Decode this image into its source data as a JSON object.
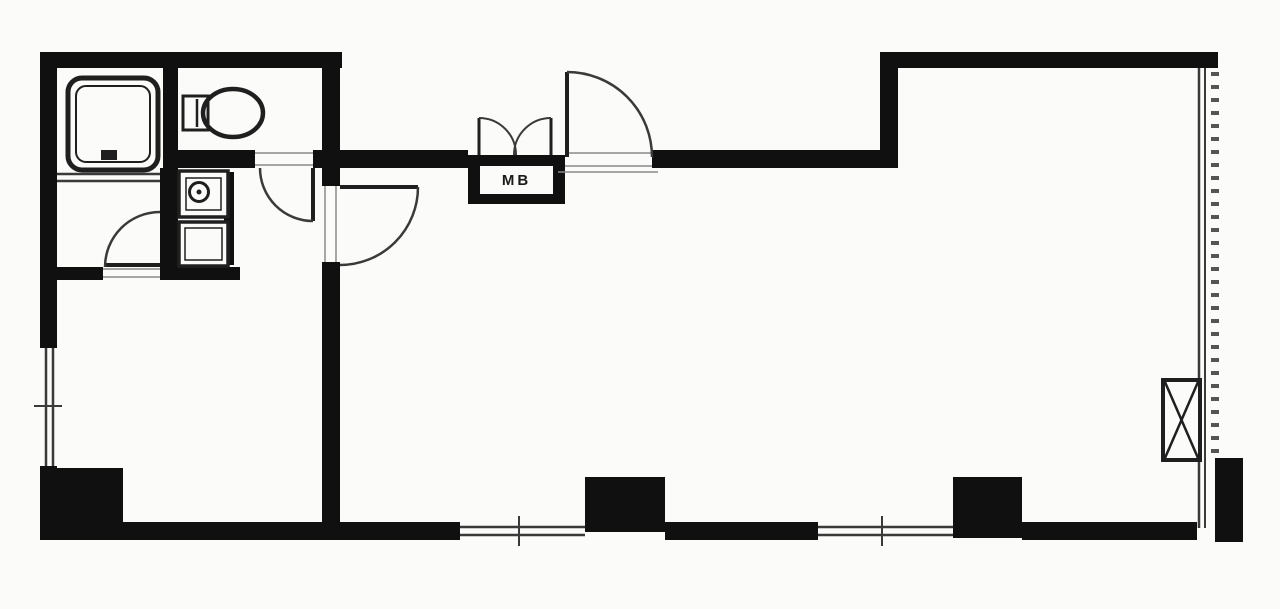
{
  "canvas": {
    "width": 1280,
    "height": 609
  },
  "colors": {
    "wall": "#101010",
    "dark": "#1f1f1f",
    "line": "#3a3a3a",
    "faint": "#8a8a8a",
    "hatch": "#555555",
    "paper": "#fbfbf9"
  },
  "labels": {
    "meter_box": "MB"
  },
  "meter_box_label_box": {
    "left": 480,
    "top": 166,
    "width": 73,
    "height": 28
  },
  "plan": {
    "shapes": [
      {
        "t": "rect",
        "n": "wall-top-left",
        "x": 40,
        "y": 52,
        "w": 302,
        "h": 16,
        "f": "wall"
      },
      {
        "t": "rect",
        "n": "wall-top-right",
        "x": 880,
        "y": 52,
        "w": 338,
        "h": 16,
        "f": "wall"
      },
      {
        "t": "rect",
        "n": "wall-left-upper",
        "x": 40,
        "y": 52,
        "w": 17,
        "h": 296,
        "f": "wall"
      },
      {
        "t": "rect",
        "n": "wall-left-lower",
        "x": 40,
        "y": 466,
        "w": 17,
        "h": 74,
        "f": "wall"
      },
      {
        "t": "rect",
        "n": "wall-north-west-of-entrance",
        "x": 322,
        "y": 150,
        "w": 146,
        "h": 18,
        "f": "wall"
      },
      {
        "t": "rect",
        "n": "wall-north-east-of-entrance",
        "x": 652,
        "y": 150,
        "w": 246,
        "h": 18,
        "f": "wall"
      },
      {
        "t": "rect",
        "n": "wall-toilet-south-left",
        "x": 178,
        "y": 150,
        "w": 77,
        "h": 18,
        "f": "wall"
      },
      {
        "t": "rect",
        "n": "wall-toilet-south-right",
        "x": 313,
        "y": 150,
        "w": 14,
        "h": 18,
        "f": "wall"
      },
      {
        "t": "rect",
        "n": "wall-step-vertical",
        "x": 880,
        "y": 52,
        "w": 18,
        "h": 116,
        "f": "wall"
      },
      {
        "t": "rect",
        "n": "wall-main-vertical-upper",
        "x": 322,
        "y": 52,
        "w": 18,
        "h": 134,
        "f": "wall"
      },
      {
        "t": "rect",
        "n": "wall-main-vertical-lower",
        "x": 322,
        "y": 262,
        "w": 18,
        "h": 263,
        "f": "wall"
      },
      {
        "t": "rect",
        "n": "wall-bath-toilet-divider",
        "x": 163,
        "y": 52,
        "w": 15,
        "h": 131,
        "f": "wall"
      },
      {
        "t": "rect",
        "n": "wall-washroom-east",
        "x": 160,
        "y": 168,
        "w": 18,
        "h": 112,
        "f": "wall"
      },
      {
        "t": "rect",
        "n": "wall-washroom-south",
        "x": 55,
        "y": 267,
        "w": 48,
        "h": 13,
        "f": "wall"
      },
      {
        "t": "rect",
        "n": "wall-niche-south",
        "x": 160,
        "y": 267,
        "w": 80,
        "h": 13,
        "f": "wall"
      },
      {
        "t": "rect",
        "n": "wall-niche-east",
        "x": 224,
        "y": 172,
        "w": 10,
        "h": 93,
        "f": "wall"
      },
      {
        "t": "rect",
        "n": "wall-bottom-left",
        "x": 40,
        "y": 522,
        "w": 420,
        "h": 18,
        "f": "wall"
      },
      {
        "t": "rect",
        "n": "wall-bottom-middle",
        "x": 665,
        "y": 522,
        "w": 153,
        "h": 18,
        "f": "wall"
      },
      {
        "t": "rect",
        "n": "wall-bottom-right",
        "x": 1022,
        "y": 522,
        "w": 175,
        "h": 18,
        "f": "wall"
      },
      {
        "t": "rect",
        "n": "column-southwest",
        "x": 43,
        "y": 468,
        "w": 80,
        "h": 70,
        "f": "wall"
      },
      {
        "t": "rect",
        "n": "column-south-center",
        "x": 585,
        "y": 477,
        "w": 80,
        "h": 55,
        "f": "wall"
      },
      {
        "t": "rect",
        "n": "column-south-east",
        "x": 953,
        "y": 477,
        "w": 69,
        "h": 61,
        "f": "wall"
      },
      {
        "t": "rect",
        "n": "column-southeast-corner",
        "x": 1215,
        "y": 458,
        "w": 28,
        "h": 84,
        "f": "wall"
      },
      {
        "t": "rect",
        "n": "meter-box-frame",
        "x": 468,
        "y": 155,
        "w": 97,
        "h": 49,
        "f": "wall"
      },
      {
        "t": "rect",
        "n": "meter-box-inner",
        "x": 480,
        "y": 166,
        "w": 73,
        "h": 28,
        "f": "paper"
      },
      {
        "t": "line",
        "n": "bath-partition-line-1",
        "x1": 57,
        "y1": 174,
        "x2": 160,
        "y2": 174,
        "s": "line",
        "sw": 2.5
      },
      {
        "t": "line",
        "n": "bath-partition-line-2",
        "x1": 57,
        "y1": 181,
        "x2": 160,
        "y2": 181,
        "s": "line",
        "sw": 2.5
      },
      {
        "t": "line",
        "n": "window-west-outer",
        "x1": 46,
        "y1": 348,
        "x2": 46,
        "y2": 466,
        "s": "line",
        "sw": 2.5
      },
      {
        "t": "line",
        "n": "window-west-inner",
        "x1": 53,
        "y1": 348,
        "x2": 53,
        "y2": 466,
        "s": "line",
        "sw": 2.5
      },
      {
        "t": "line",
        "n": "window-west-tick",
        "x1": 34,
        "y1": 406,
        "x2": 62,
        "y2": 406,
        "s": "line",
        "sw": 2
      },
      {
        "t": "line",
        "n": "window-south1-outer",
        "x1": 460,
        "y1": 535,
        "x2": 585,
        "y2": 535,
        "s": "line",
        "sw": 2.5
      },
      {
        "t": "line",
        "n": "window-south1-inner",
        "x1": 460,
        "y1": 527,
        "x2": 585,
        "y2": 527,
        "s": "line",
        "sw": 2.5
      },
      {
        "t": "line",
        "n": "window-south1-tick",
        "x1": 519,
        "y1": 516,
        "x2": 519,
        "y2": 546,
        "s": "line",
        "sw": 2
      },
      {
        "t": "line",
        "n": "window-south2-outer",
        "x1": 818,
        "y1": 535,
        "x2": 953,
        "y2": 535,
        "s": "line",
        "sw": 2.5
      },
      {
        "t": "line",
        "n": "window-south2-inner",
        "x1": 818,
        "y1": 527,
        "x2": 953,
        "y2": 527,
        "s": "line",
        "sw": 2.5
      },
      {
        "t": "line",
        "n": "window-south2-tick",
        "x1": 882,
        "y1": 516,
        "x2": 882,
        "y2": 546,
        "s": "line",
        "sw": 2
      },
      {
        "t": "line",
        "n": "window-east-outer",
        "x1": 1199,
        "y1": 68,
        "x2": 1199,
        "y2": 528,
        "s": "line",
        "sw": 2.5
      },
      {
        "t": "line",
        "n": "window-east-inner",
        "x1": 1205,
        "y1": 68,
        "x2": 1205,
        "y2": 528,
        "s": "line",
        "sw": 2
      },
      {
        "t": "line",
        "n": "balcony-hatch",
        "x1": 1215,
        "y1": 72,
        "x2": 1215,
        "y2": 456,
        "s": "hatch",
        "sw": 8,
        "dash": "4 9"
      },
      {
        "t": "line",
        "n": "entrance-threshold-top",
        "x1": 565,
        "y1": 153,
        "x2": 652,
        "y2": 153,
        "s": "faint",
        "sw": 1.5
      },
      {
        "t": "line",
        "n": "entrance-threshold-bottom",
        "x1": 565,
        "y1": 166,
        "x2": 652,
        "y2": 166,
        "s": "faint",
        "sw": 1.5
      },
      {
        "t": "line",
        "n": "entrance-step",
        "x1": 558,
        "y1": 172,
        "x2": 658,
        "y2": 172,
        "s": "faint",
        "sw": 1.5
      },
      {
        "t": "line",
        "n": "toilet-door-threshold-top",
        "x1": 255,
        "y1": 153,
        "x2": 313,
        "y2": 153,
        "s": "faint",
        "sw": 1.5
      },
      {
        "t": "line",
        "n": "toilet-door-threshold-bottom",
        "x1": 255,
        "y1": 165,
        "x2": 313,
        "y2": 165,
        "s": "faint",
        "sw": 1.5
      },
      {
        "t": "line",
        "n": "west-door-jamb-left",
        "x1": 325,
        "y1": 186,
        "x2": 325,
        "y2": 262,
        "s": "faint",
        "sw": 1.5
      },
      {
        "t": "line",
        "n": "west-door-jamb-right",
        "x1": 336,
        "y1": 186,
        "x2": 336,
        "y2": 262,
        "s": "faint",
        "sw": 1.5
      },
      {
        "t": "line",
        "n": "washroom-door-threshold-top",
        "x1": 103,
        "y1": 269,
        "x2": 160,
        "y2": 269,
        "s": "faint",
        "sw": 1.5
      },
      {
        "t": "line",
        "n": "washroom-door-threshold-bottom",
        "x1": 103,
        "y1": 277,
        "x2": 160,
        "y2": 277,
        "s": "faint",
        "sw": 1.5
      },
      {
        "t": "line",
        "n": "entrance-door-leaf",
        "x1": 567,
        "y1": 157,
        "x2": 567,
        "y2": 72,
        "s": "dark",
        "sw": 4
      },
      {
        "t": "path",
        "n": "entrance-door-arc",
        "d": "M 567 72 A 85 85 0 0 1 652 157",
        "s": "line",
        "sw": 2.5
      },
      {
        "t": "line",
        "n": "meterbox-door-left-leaf",
        "x1": 479,
        "y1": 155,
        "x2": 479,
        "y2": 118,
        "s": "dark",
        "sw": 3
      },
      {
        "t": "path",
        "n": "meterbox-door-left-arc",
        "d": "M 479 118 A 37 37 0 0 1 516 155",
        "s": "line",
        "sw": 2
      },
      {
        "t": "line",
        "n": "meterbox-door-right-leaf",
        "x1": 551,
        "y1": 155,
        "x2": 551,
        "y2": 118,
        "s": "dark",
        "sw": 3
      },
      {
        "t": "path",
        "n": "meterbox-door-right-arc",
        "d": "M 551 118 A 37 37 0 0 0 514 155",
        "s": "line",
        "sw": 2
      },
      {
        "t": "line",
        "n": "toilet-door-leaf",
        "x1": 313,
        "y1": 168,
        "x2": 313,
        "y2": 221,
        "s": "dark",
        "sw": 4
      },
      {
        "t": "path",
        "n": "toilet-door-arc",
        "d": "M 260 168 A 53 53 0 0 0 313 221",
        "s": "line",
        "sw": 2.5
      },
      {
        "t": "line",
        "n": "west-room-door-leaf",
        "x1": 340,
        "y1": 187,
        "x2": 418,
        "y2": 187,
        "s": "dark",
        "sw": 4
      },
      {
        "t": "path",
        "n": "west-room-door-arc",
        "d": "M 418 187 A 78 78 0 0 1 340 265",
        "s": "line",
        "sw": 2.5
      },
      {
        "t": "line",
        "n": "washroom-door-leaf",
        "x1": 105,
        "y1": 265,
        "x2": 160,
        "y2": 265,
        "s": "dark",
        "sw": 4
      },
      {
        "t": "path",
        "n": "washroom-door-arc",
        "d": "M 105 267 A 55 55 0 0 1 160 212",
        "s": "line",
        "sw": 2.5
      },
      {
        "t": "rect",
        "n": "bathtub-outer",
        "x": 68,
        "y": 78,
        "w": 90,
        "h": 92,
        "rx": 14,
        "s": "dark",
        "sw": 5,
        "f": "paper"
      },
      {
        "t": "rect",
        "n": "bathtub-inner",
        "x": 76,
        "y": 86,
        "w": 74,
        "h": 76,
        "rx": 10,
        "s": "dark",
        "sw": 2
      },
      {
        "t": "rect",
        "n": "bathtub-drain",
        "x": 101,
        "y": 150,
        "w": 16,
        "h": 10,
        "f": "dark"
      },
      {
        "t": "rect",
        "n": "toilet-tank",
        "x": 183,
        "y": 96,
        "w": 25,
        "h": 34,
        "s": "dark",
        "sw": 3,
        "f": "paper"
      },
      {
        "t": "line",
        "n": "toilet-tank-line",
        "x1": 197,
        "y1": 99,
        "x2": 197,
        "y2": 127,
        "s": "dark",
        "sw": 2.5
      },
      {
        "t": "ellipse",
        "n": "toilet-bowl",
        "cx": 233,
        "cy": 113,
        "rx": 30,
        "ry": 24,
        "s": "dark",
        "sw": 4.5
      },
      {
        "t": "rect",
        "n": "washbasin-outer",
        "x": 179,
        "y": 171,
        "w": 49,
        "h": 46,
        "s": "dark",
        "sw": 3.5,
        "f": "paper"
      },
      {
        "t": "rect",
        "n": "washbasin-inner",
        "x": 186,
        "y": 178,
        "w": 35,
        "h": 32,
        "s": "dark",
        "sw": 1.5
      },
      {
        "t": "circle",
        "n": "washbasin-faucet",
        "cx": 199,
        "cy": 192,
        "r": 9.5,
        "s": "dark",
        "sw": 3
      },
      {
        "t": "circle",
        "n": "washbasin-drain",
        "cx": 199,
        "cy": 192,
        "r": 2.5,
        "f": "dark"
      },
      {
        "t": "rect",
        "n": "laundry-pan-outer",
        "x": 179,
        "y": 222,
        "w": 49,
        "h": 44,
        "s": "dark",
        "sw": 3.5,
        "f": "paper"
      },
      {
        "t": "rect",
        "n": "laundry-pan-inner",
        "x": 185,
        "y": 228,
        "w": 37,
        "h": 32,
        "s": "dark",
        "sw": 1.5
      },
      {
        "t": "rect",
        "n": "pipe-shaft-box",
        "x": 1163,
        "y": 380,
        "w": 37,
        "h": 80,
        "s": "dark",
        "sw": 4,
        "f": "paper"
      },
      {
        "t": "line",
        "n": "pipe-shaft-x1",
        "x1": 1165,
        "y1": 382,
        "x2": 1198,
        "y2": 458,
        "s": "dark",
        "sw": 2.5
      },
      {
        "t": "line",
        "n": "pipe-shaft-x2",
        "x1": 1198,
        "y1": 382,
        "x2": 1165,
        "y2": 458,
        "s": "dark",
        "sw": 2.5
      }
    ]
  }
}
